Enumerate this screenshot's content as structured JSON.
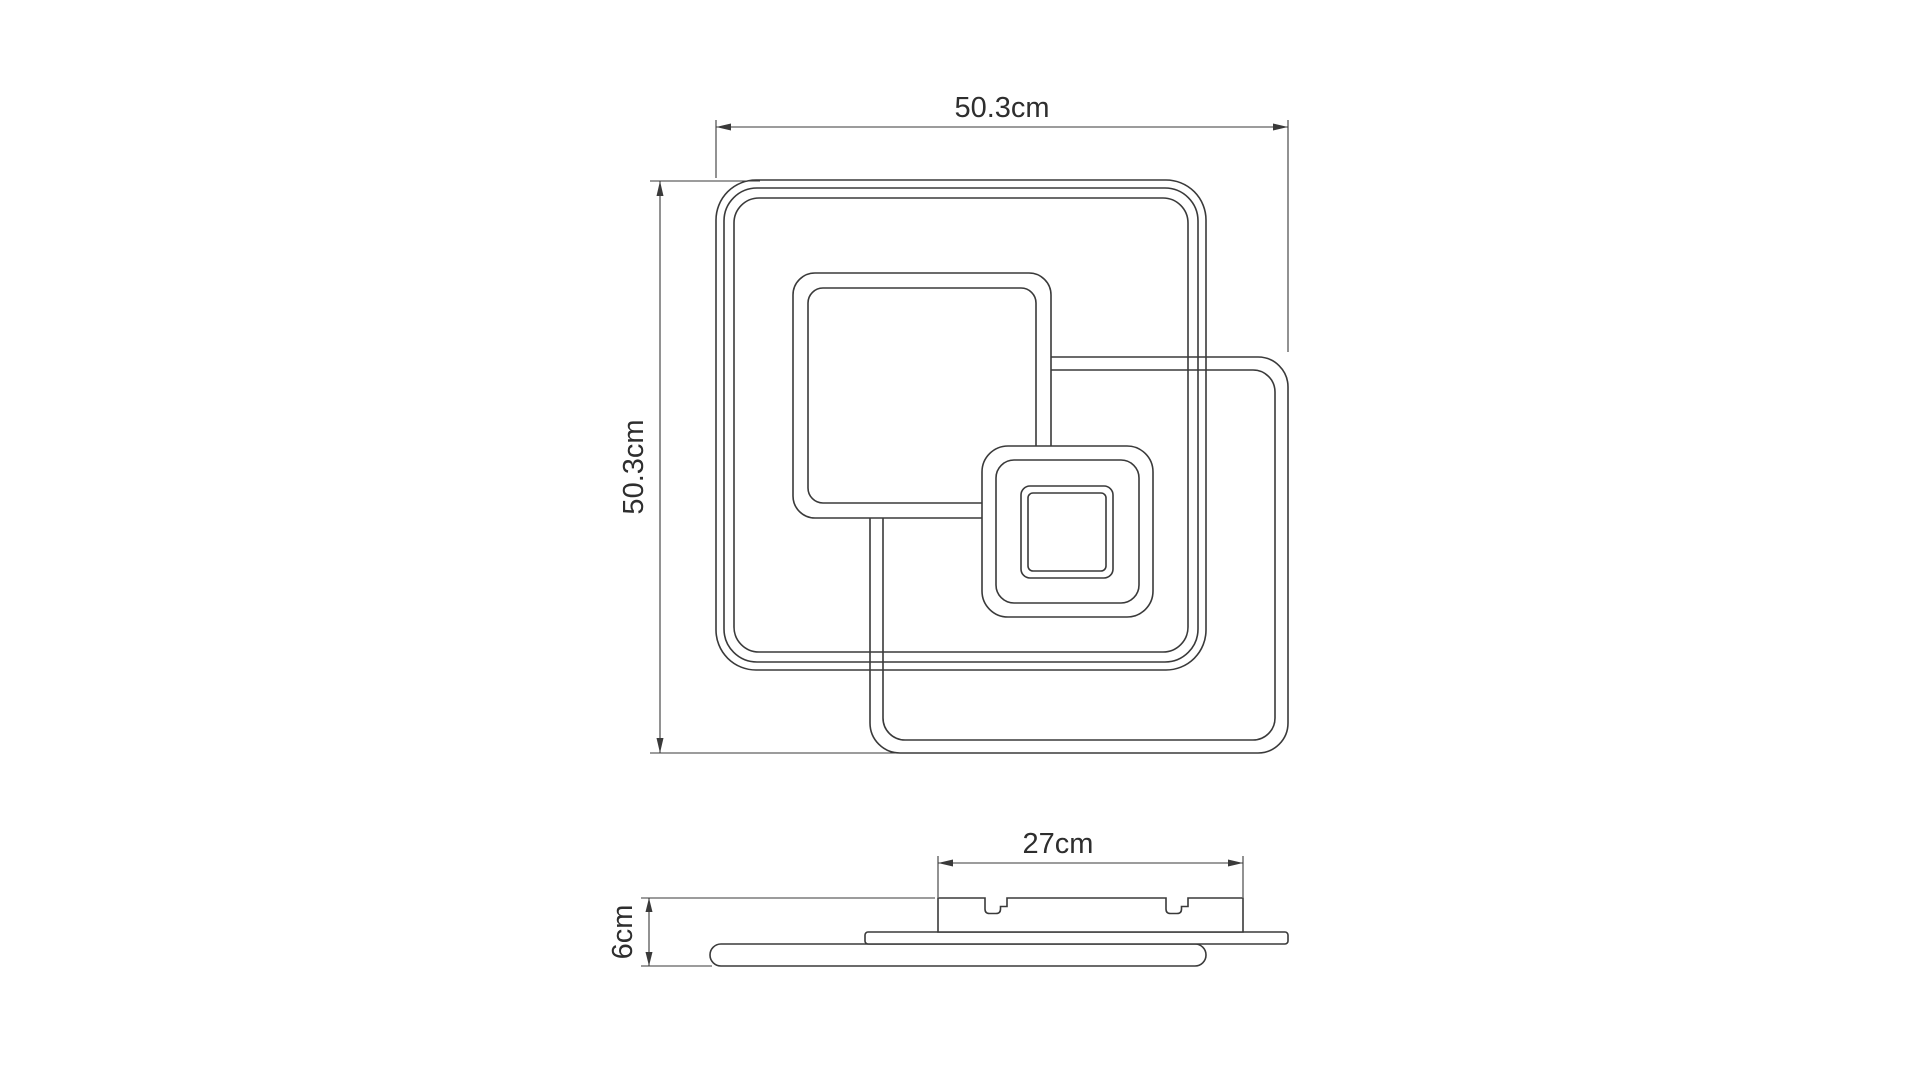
{
  "drawing": {
    "background_color": "#ffffff",
    "line_color": "#3a3a3a",
    "dimensions": {
      "overall_width_label": "50.3cm",
      "overall_height_label": "50.3cm",
      "mount_plate_width_label": "27cm",
      "fixture_depth_label": "6cm"
    }
  }
}
